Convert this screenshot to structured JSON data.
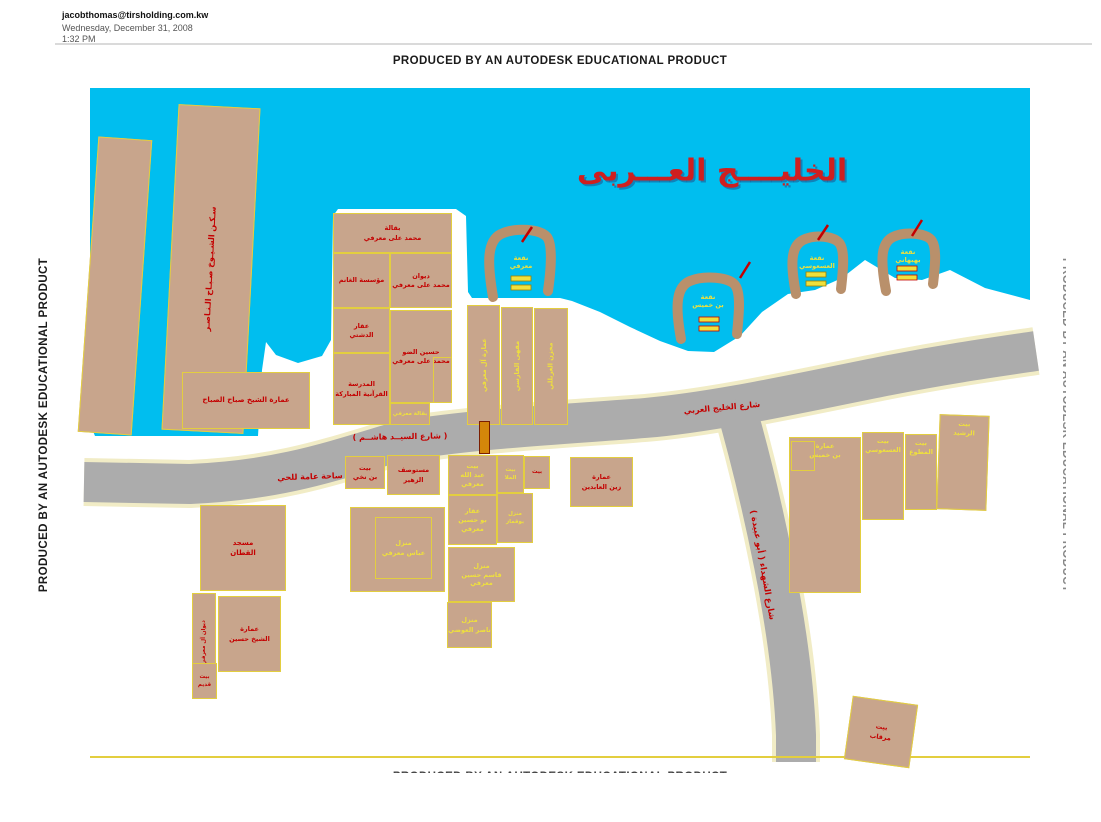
{
  "header": {
    "email": "jacobthomas@tirsholding.com.kw",
    "date": "Wednesday, December 31, 2008",
    "time": "1:32 PM",
    "watermark": "PRODUCED BY AN AUTODESK EDUCATIONAL PRODUCT"
  },
  "map": {
    "sea_label": "الخليــــج العـــربى",
    "colors": {
      "water": "#00BEEF",
      "road": "#ACACAC",
      "road_edge": "#F1ECC6",
      "parcel": "#C8A58C",
      "parcel_border": "#E3CE3F",
      "pier": "#B9906B",
      "red": "#C40000",
      "yellow": "#EFE03C",
      "marker": "#D4860A",
      "marker_border": "#7A1E00"
    },
    "water_points": "90,88 1030,88 1030,300 985,288 950,270 922,280 895,278 865,260 842,278 815,290 788,294 762,312 740,336 714,352 688,351 660,341 630,327 600,312 572,301 560,298 472,298 468,292 466,216 456,209 338,209 333,216 331,340 322,356 298,363 276,355 266,342 262,370 258,436 95,436 90,424",
    "roads": [
      {
        "name": "gulf-street-road",
        "d": "M 84,482 L 190,484 C 280,480 330,462 400,441 C 480,428 570,424 645,418 C 715,412 800,393 880,377 C 945,364 995,357 1036,351",
        "w": 40
      },
      {
        "name": "shuhada-street-road",
        "d": "M 734,400 C 748,448 762,505 774,565 C 786,625 794,685 796,735 L 796,762",
        "w": 40
      }
    ],
    "road_labels": [
      {
        "text": "( شارع السيــد هاشــم )",
        "x": 400,
        "y": 437,
        "rot": -1,
        "size": 8
      },
      {
        "text": "شارع الخليج العربي",
        "x": 722,
        "y": 408,
        "rot": -5,
        "size": 8
      },
      {
        "text": "ساحة عامة للحي",
        "x": 310,
        "y": 477,
        "rot": -2,
        "size": 8
      },
      {
        "text": "شارع الشهداء ( أبو عبيدة )",
        "x": 762,
        "y": 565,
        "rot": 80,
        "size": 8.5
      }
    ],
    "marker": {
      "x": 479,
      "y": 421,
      "w": 11,
      "h": 33
    },
    "piers": [
      {
        "name": "pier-marafi",
        "d": "M 493,297 C 487,262 487,241 501,234 C 516,227 540,229 547,237 C 553,245 551,270 548,291",
        "label": [
          "نقعة",
          "معرفي"
        ],
        "lx": 521,
        "ly": 263,
        "boats": [
          [
            511,
            276
          ],
          [
            511,
            285
          ]
        ],
        "boat_stroke": "#A08000",
        "slash": [
          522,
          242,
          532,
          227
        ]
      },
      {
        "name": "pier-bin-khamis",
        "d": "M 681,339 C 675,306 676,287 690,281 C 704,275 729,277 735,285 C 741,293 739,314 737,334",
        "label": [
          "نقعة",
          "بن خميس"
        ],
        "lx": 708,
        "ly": 302,
        "boats": [
          [
            699,
            317
          ],
          [
            699,
            326
          ]
        ],
        "boat_stroke": "#C40000",
        "slash": [
          740,
          278,
          750,
          262
        ]
      },
      {
        "name": "pier-asousi",
        "d": "M 796,294 C 790,263 791,246 803,240 C 815,234 835,236 840,244 C 845,252 843,271 841,289",
        "label": [
          "نقعة",
          "العسعوسي"
        ],
        "lx": 817,
        "ly": 263,
        "boats": [
          [
            806,
            272
          ],
          [
            806,
            281
          ]
        ],
        "boat_stroke": "#A08000",
        "slash": [
          818,
          240,
          828,
          225
        ]
      },
      {
        "name": "pier-behbehani",
        "d": "M 886,291 C 880,259 881,243 893,237 C 905,231 927,233 932,241 C 937,249 935,267 933,284",
        "label": [
          "نقعة",
          "بهبهاني"
        ],
        "lx": 908,
        "ly": 257,
        "boats": [
          [
            897,
            266
          ],
          [
            897,
            275
          ]
        ],
        "boat_stroke": "#C40000",
        "slash": [
          912,
          236,
          922,
          220
        ]
      }
    ],
    "parcels": [
      {
        "name": "parcel-diagonal-strip-west",
        "x": 88,
        "y": 138,
        "w": 54,
        "h": 296,
        "rot": 4,
        "lines": []
      },
      {
        "name": "parcel-sheikh-housing-strip",
        "x": 170,
        "y": 106,
        "w": 82,
        "h": 326,
        "rot": 3,
        "lines": [
          "سـكـن الشـيـوخ صـبـاح الـنـاصـر"
        ],
        "color": "red",
        "vert": true,
        "size": 8
      },
      {
        "name": "parcel-sheikh-sabah-building",
        "x": 182,
        "y": 372,
        "w": 128,
        "h": 57,
        "lines": [
          "عمارة الشيخ صباح الصباح"
        ],
        "color": "red",
        "size": 7
      },
      {
        "name": "parcel-grocery-marafi",
        "x": 333,
        "y": 213,
        "w": 119,
        "h": 40,
        "lines": [
          "بقالة",
          "محمد على معرفي"
        ],
        "color": "red"
      },
      {
        "name": "parcel-alghanim-est",
        "x": 333,
        "y": 253,
        "w": 57,
        "h": 55,
        "lines": [
          "مؤسسة الغانم"
        ],
        "color": "red"
      },
      {
        "name": "parcel-diwan-marafi",
        "x": 390,
        "y": 253,
        "w": 62,
        "h": 55,
        "lines": [
          "ديوان",
          "محمد على معرفي"
        ],
        "color": "red"
      },
      {
        "name": "parcel-dashti-property",
        "x": 333,
        "y": 308,
        "w": 57,
        "h": 45,
        "lines": [
          "عقار",
          "الدشتي"
        ],
        "color": "red"
      },
      {
        "name": "parcel-hussain-marafi",
        "x": 390,
        "y": 310,
        "w": 62,
        "h": 93,
        "lines": [
          "حسين الضو",
          "محمد على معرفي"
        ],
        "color": "red"
      },
      {
        "name": "parcel-quran-school",
        "x": 333,
        "y": 353,
        "w": 57,
        "h": 72,
        "lines": [
          "المدرسة",
          "القرآنية المباركة"
        ],
        "color": "red"
      },
      {
        "name": "parcel-small-grocery",
        "x": 390,
        "y": 403,
        "w": 40,
        "h": 22,
        "lines": [
          "بقالة معرفي"
        ],
        "color": "yellow",
        "size": 5.5
      },
      {
        "name": "parcel-inner-annex",
        "x": 433,
        "y": 357,
        "w": 19,
        "h": 46,
        "fill": "none",
        "lines": []
      },
      {
        "name": "parcel-marafi-building-strip",
        "x": 467,
        "y": 305,
        "w": 33,
        "h": 120,
        "lines": [
          "عمارة آل معرفي"
        ],
        "color": "yellow",
        "vert": true
      },
      {
        "name": "parcel-farsi-cafe-strip",
        "x": 501,
        "y": 307,
        "w": 32,
        "h": 118,
        "lines": [
          "مقهى الفارسي"
        ],
        "color": "yellow",
        "vert": true
      },
      {
        "name": "parcel-gharabally-store-strip",
        "x": 534,
        "y": 308,
        "w": 34,
        "h": 117,
        "lines": [
          "مخزن الغربللي"
        ],
        "color": "yellow",
        "vert": true
      },
      {
        "name": "parcel-bin-nakhi-house",
        "x": 345,
        "y": 456,
        "w": 40,
        "h": 33,
        "lines": [
          "بيت",
          "بن نخي"
        ],
        "color": "red"
      },
      {
        "name": "parcel-zuhair-clinic",
        "x": 387,
        "y": 455,
        "w": 53,
        "h": 40,
        "lines": [
          "مستوصف",
          "الزهير"
        ],
        "color": "red"
      },
      {
        "name": "parcel-abbas-marafi-plot",
        "x": 350,
        "y": 507,
        "w": 95,
        "h": 85,
        "lines": []
      },
      {
        "name": "parcel-abbas-marafi-house",
        "x": 375,
        "y": 517,
        "w": 57,
        "h": 62,
        "fill": "none",
        "lines": [
          "منزل",
          "عباس معرفي"
        ],
        "color": "yellow"
      },
      {
        "name": "parcel-abdullah-marafi-house",
        "x": 448,
        "y": 455,
        "w": 49,
        "h": 40,
        "lines": [
          "بيت",
          "عبد الله معرفي"
        ],
        "color": "yellow"
      },
      {
        "name": "parcel-bu-hussain-property",
        "x": 448,
        "y": 495,
        "w": 49,
        "h": 50,
        "lines": [
          "عقار",
          "بو حسين معرفي"
        ],
        "color": "yellow"
      },
      {
        "name": "parcel-qasim-hussain-house",
        "x": 448,
        "y": 547,
        "w": 67,
        "h": 55,
        "lines": [
          "منزل",
          "قاسم حسين معرفي"
        ],
        "color": "yellow"
      },
      {
        "name": "parcel-nasser-awadhi-house",
        "x": 447,
        "y": 602,
        "w": 45,
        "h": 46,
        "lines": [
          "منزل",
          "ناصر العوضي"
        ],
        "color": "yellow"
      },
      {
        "name": "parcel-mulla-house",
        "x": 497,
        "y": 455,
        "w": 27,
        "h": 38,
        "lines": [
          "بيت",
          "الملا"
        ],
        "color": "yellow",
        "size": 5.5
      },
      {
        "name": "parcel-small-house",
        "x": 524,
        "y": 456,
        "w": 26,
        "h": 33,
        "lines": [
          "بيت"
        ],
        "color": "red",
        "size": 5.5
      },
      {
        "name": "parcel-buqammaz-house",
        "x": 497,
        "y": 493,
        "w": 36,
        "h": 50,
        "lines": [
          "منزل",
          "بوقماز"
        ],
        "color": "yellow",
        "size": 5.5
      },
      {
        "name": "parcel-zainal-abdeen-building",
        "x": 570,
        "y": 457,
        "w": 63,
        "h": 50,
        "lines": [
          "عمارة",
          "زين العابدين"
        ],
        "color": "red"
      },
      {
        "name": "parcel-qattan-mosque",
        "x": 200,
        "y": 505,
        "w": 86,
        "h": 86,
        "lines": [
          "مسجد",
          "القطان"
        ],
        "color": "red",
        "size": 7
      },
      {
        "name": "parcel-marafi-diwan-strip",
        "x": 192,
        "y": 593,
        "w": 24,
        "h": 98,
        "lines": [
          "ديوان آل معرفي"
        ],
        "color": "red",
        "vert": true,
        "size": 5.5
      },
      {
        "name": "parcel-sheikh-hussain-building",
        "x": 218,
        "y": 596,
        "w": 63,
        "h": 76,
        "lines": [
          "عمارة",
          "الشيخ حسين"
        ],
        "color": "red"
      },
      {
        "name": "parcel-old-house",
        "x": 192,
        "y": 663,
        "w": 25,
        "h": 36,
        "lines": [
          "بيت",
          "قديم"
        ],
        "color": "red",
        "size": 5.5
      },
      {
        "name": "parcel-bin-khamis-building",
        "x": 789,
        "y": 437,
        "w": 72,
        "h": 156,
        "lines": [
          "عمارة",
          "بن خميس"
        ],
        "color": "yellow",
        "top": true
      },
      {
        "name": "parcel-bin-khamis-annex",
        "x": 791,
        "y": 441,
        "w": 24,
        "h": 30,
        "fill": "none",
        "lines": []
      },
      {
        "name": "parcel-asousi-house",
        "x": 862,
        "y": 432,
        "w": 42,
        "h": 88,
        "lines": [
          "بيت",
          "العسعوسي"
        ],
        "color": "yellow",
        "top": true
      },
      {
        "name": "parcel-mutawa-house",
        "x": 905,
        "y": 434,
        "w": 32,
        "h": 76,
        "lines": [
          "بيت",
          "المطوع"
        ],
        "color": "yellow",
        "top": true
      },
      {
        "name": "parcel-rashed-house",
        "x": 938,
        "y": 415,
        "w": 50,
        "h": 95,
        "rot": 2,
        "lines": [
          "بيت",
          "الرشيد"
        ],
        "color": "yellow",
        "top": true
      },
      {
        "name": "parcel-mirqab-plot",
        "x": 848,
        "y": 700,
        "w": 66,
        "h": 64,
        "rot": 8,
        "lines": [
          "بيت",
          "مرقاب"
        ],
        "color": "red"
      }
    ]
  }
}
